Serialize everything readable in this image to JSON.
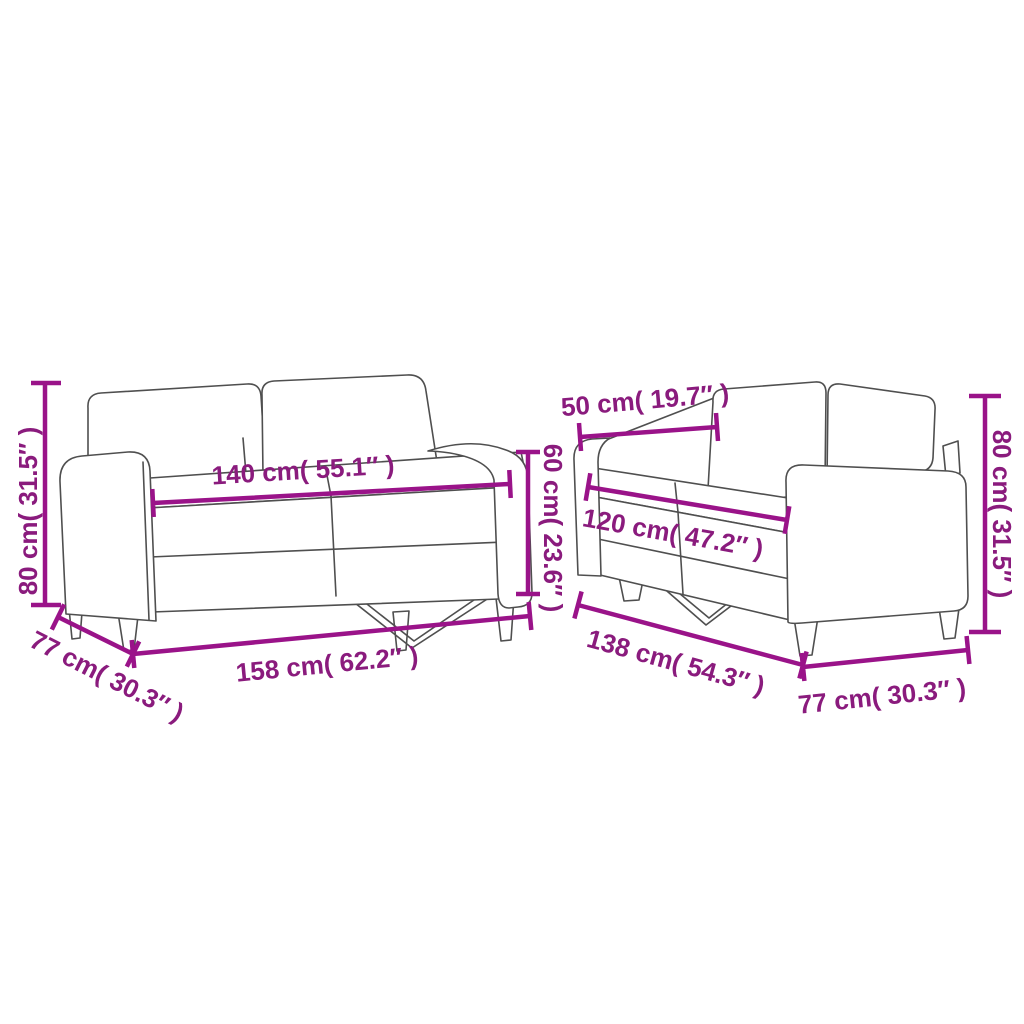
{
  "diagram": {
    "kind": "product dimension drawing",
    "subject": "2-piece sofa set line drawing",
    "background_color": "#ffffff",
    "dimension_color": "#8a1b7d",
    "line_color": "#9a1389",
    "outline_color": "#4f4f4f"
  },
  "sofas": [
    {
      "name": "large two-seater sofa (left)",
      "dimensions": [
        {
          "id": "overall-height",
          "text": "80 cm( 31.5″ )",
          "cm": 80,
          "inches": 31.5,
          "placement": "vertical-left"
        },
        {
          "id": "seat-width",
          "text": "140 cm( 55.1″ )",
          "cm": 140,
          "inches": 55.1,
          "placement": "across-seat"
        },
        {
          "id": "depth",
          "text": "77 cm( 30.3″ )",
          "cm": 77,
          "inches": 30.3,
          "placement": "diagonal-bottom-left"
        },
        {
          "id": "overall-width",
          "text": "158 cm( 62.2″ )",
          "cm": 158,
          "inches": 62.2,
          "placement": "bottom"
        },
        {
          "id": "back-height",
          "text": "60 cm( 23.6″ )",
          "cm": 60,
          "inches": 23.6,
          "placement": "vertical-right"
        }
      ]
    },
    {
      "name": "small two-seater sofa (right)",
      "dimensions": [
        {
          "id": "seat-depth",
          "text": "50 cm( 19.7″ )",
          "cm": 50,
          "inches": 19.7,
          "placement": "top-left"
        },
        {
          "id": "seat-width",
          "text": "120 cm( 47.2″ )",
          "cm": 120,
          "inches": 47.2,
          "placement": "across-seat"
        },
        {
          "id": "overall-width",
          "text": "138 cm( 54.3″ )",
          "cm": 138,
          "inches": 54.3,
          "placement": "diagonal-bottom-left"
        },
        {
          "id": "depth",
          "text": "77 cm( 30.3″ )",
          "cm": 77,
          "inches": 30.3,
          "placement": "bottom-right"
        },
        {
          "id": "overall-height",
          "text": "80 cm( 31.5″ )",
          "cm": 80,
          "inches": 31.5,
          "placement": "vertical-right"
        }
      ]
    }
  ]
}
